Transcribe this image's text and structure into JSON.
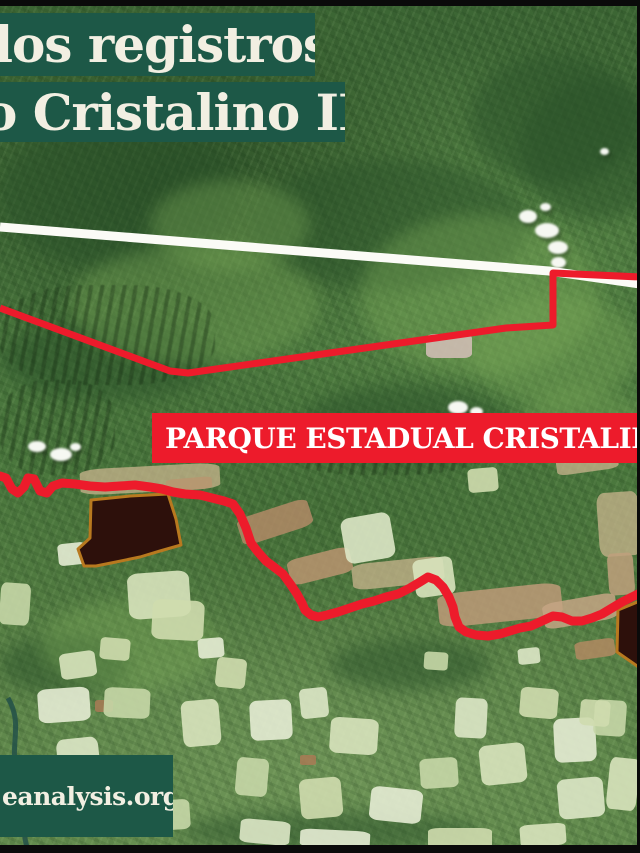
{
  "title_card": {
    "line1": "dos registros",
    "line2": "o Cristalino II"
  },
  "park_label": {
    "text": "PARQUE ESTADUAL CRISTALINO"
  },
  "source_tag": {
    "text": "eanalysis.org/"
  },
  "colors": {
    "banner_green": "#1d5847",
    "banner_text": "#f2efe2",
    "label_red": "#ed1b2b",
    "label_text": "#ffffff",
    "boundary_red": "#ed1b2b",
    "survey_line_white": "#fbfbf6",
    "registry_fill": "#2d100b",
    "registry_stroke": "#b8791f",
    "frame_black": "#0a0a0a"
  },
  "map": {
    "survey_line": {
      "name": "survey-cut-line",
      "points": "0,227 549,271 640,284"
    },
    "boundary_north": {
      "name": "park-boundary-north",
      "points": "0,308 170,371 188,373 506,328 553,325 553,273 640,277"
    },
    "boundary_south": {
      "name": "park-boundary-south",
      "points": "0,476 6,478 12,489 18,493 24,487 28,478 34,479 40,491 47,493 53,486 62,483 75,484 90,486 105,487 120,486 135,485 150,487 162,489 173,492 185,494 200,495 212,498 224,501 233,504 240,514 246,528 251,543 258,552 266,561 274,567 283,574 291,585 297,594 302,603 305,610 311,615 318,617 327,615 338,612 350,608 362,604 374,601 386,597 398,594 410,588 420,582 428,577 436,580 443,587 449,597 453,607 455,617 459,627 466,632 476,635 488,636 500,634 510,631 520,628 531,626 542,621 553,616 562,617 572,621 582,621 592,618 602,614 612,608 622,602 632,597 640,593"
    },
    "registries": [
      {
        "name": "deforestation-registry-polygon-west",
        "points": "91,500 130,496 168,494 176,519 181,545 160,551 140,557 116,562 96,566 84,566 78,549 90,538"
      },
      {
        "name": "deforestation-registry-polygon-east",
        "points": "618,610 640,601 640,668 617,652"
      }
    ]
  }
}
